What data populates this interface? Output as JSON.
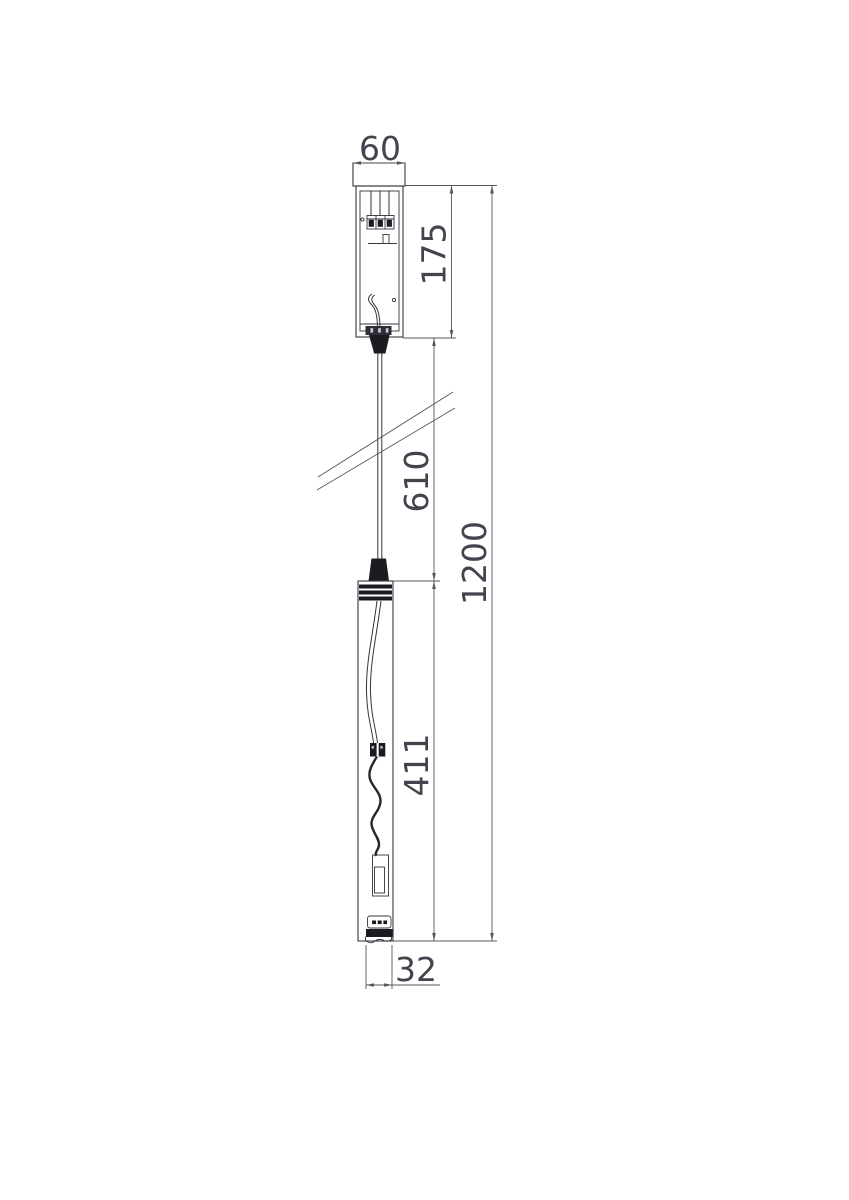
{
  "drawing": {
    "type": "technical dimensional drawing of a pendant light fixture",
    "colors": {
      "background": "#ffffff",
      "dimension_line": "#54565f",
      "object_line": "#34363e",
      "solid_fill": "#1b1c22",
      "text": "#43454e"
    },
    "dims": {
      "canopy_width": "60",
      "canopy_height": "175",
      "suspension_length": "610",
      "body_length": "411",
      "overall_height": "1200",
      "body_diameter": "32"
    }
  }
}
